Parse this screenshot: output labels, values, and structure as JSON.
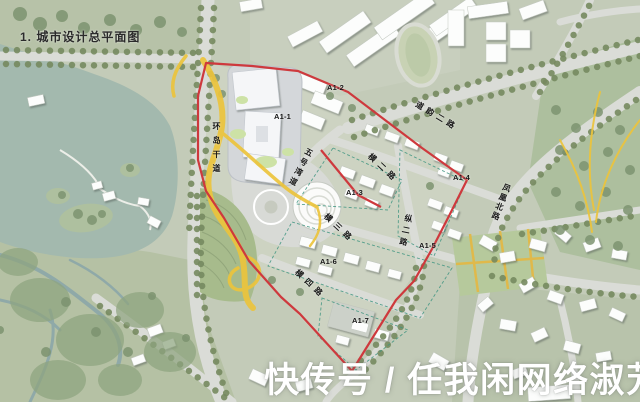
{
  "title": "1. 城市设计总平面图",
  "watermark": "快传号 / 任我闲网络淑芳",
  "parcels": [
    {
      "label": "A1-1"
    },
    {
      "label": "A1-2"
    },
    {
      "label": "A1-3"
    },
    {
      "label": "A1-4"
    },
    {
      "label": "A1-5"
    },
    {
      "label": "A1-6"
    },
    {
      "label": "A1-7"
    }
  ],
  "roads": {
    "ring_trunk": "环岛干道",
    "no5_bay": "五号湾道",
    "heng_2": "横二路",
    "heng_3": "横三路",
    "heng_4": "横四路",
    "zong_2": "纵二路",
    "daoyun_2": "道韵二路",
    "fenghuang_north": "凤凰北路"
  },
  "colors": {
    "site_boundary_red": "#ce393d",
    "landscape_ribbon_yellow": "#ecc43c",
    "water": "#a3b9ae",
    "park_green": "#b5c1a4",
    "road_grey": "#dadcd7",
    "tree_green": "#76895f",
    "parcel_dash_teal": "#3d9480",
    "watermark_white": "#ffffff"
  }
}
